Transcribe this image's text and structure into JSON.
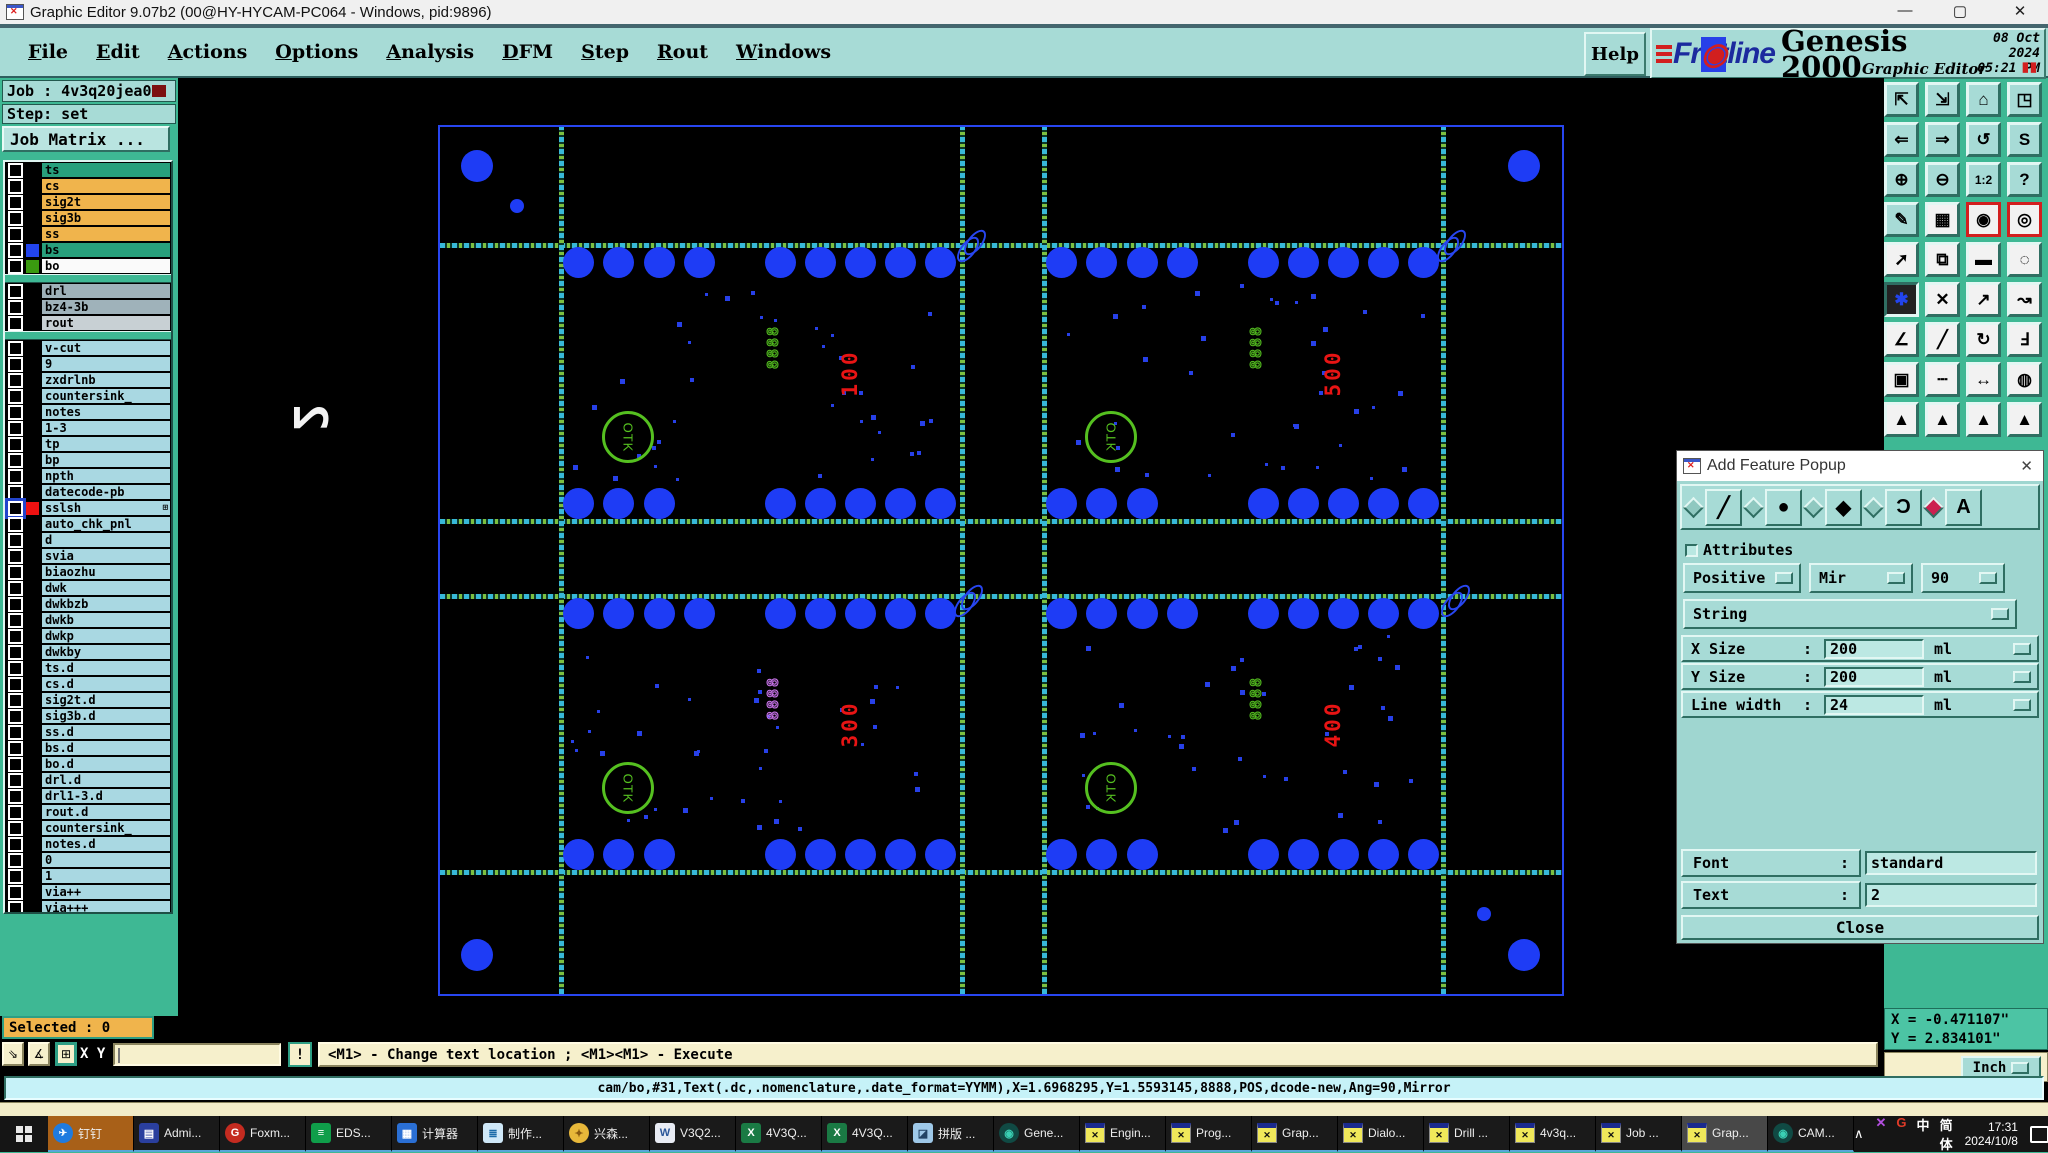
{
  "title_bar": {
    "title": "Graphic Editor 9.07b2 (00@HY-HYCAM-PC064 - Windows, pid:9896)",
    "minimize": "—",
    "maximize": "▢",
    "close": "✕"
  },
  "menu_bar": {
    "items": [
      "File",
      "Edit",
      "Actions",
      "Options",
      "Analysis",
      "DFM",
      "Step",
      "Rout",
      "Windows"
    ],
    "help": "Help"
  },
  "brand": {
    "logo_text": "Frontline",
    "product": "Genesis 2000",
    "date": "08 Oct 2024",
    "time": "05:21 PM",
    "subtitle": "Graphic Editor",
    "pause_icon": "▮▮"
  },
  "sidebar": {
    "job_label": "Job : 4v3q20jea0",
    "step_label": "Step: set",
    "job_matrix_label": "Job Matrix ...",
    "layers": [
      {
        "name": "ts",
        "bg": "teal"
      },
      {
        "name": "cs",
        "bg": "orange"
      },
      {
        "name": "sig2t",
        "bg": "orange"
      },
      {
        "name": "sig3b",
        "bg": "orange"
      },
      {
        "name": "ss",
        "bg": "orange"
      },
      {
        "name": "bs",
        "bg": "teal",
        "chip": "#2244ee"
      },
      {
        "name": "bo",
        "bg": "white",
        "chip": "#3a9a10"
      },
      {
        "gap": true
      },
      {
        "name": "drl",
        "bg": "gray"
      },
      {
        "name": "bz4-3b",
        "bg": "gray"
      },
      {
        "name": "rout",
        "bg": "lgray"
      },
      {
        "gap": true
      },
      {
        "name": "v-cut",
        "bg": "pale"
      },
      {
        "name": "9",
        "bg": "pale"
      },
      {
        "name": "zxdrlnb",
        "bg": "pale"
      },
      {
        "name": "countersink_",
        "bg": "pale"
      },
      {
        "name": "notes",
        "bg": "pale"
      },
      {
        "name": "1-3",
        "bg": "pale"
      },
      {
        "name": "tp",
        "bg": "pale"
      },
      {
        "name": "bp",
        "bg": "pale"
      },
      {
        "name": "npth",
        "bg": "pale"
      },
      {
        "name": "datecode-pb",
        "bg": "pale"
      },
      {
        "name": "sslsh",
        "bg": "pale",
        "chip": "#ee1111",
        "selected": true,
        "suffix": "⊞"
      },
      {
        "name": "auto_chk_pnl",
        "bg": "pale"
      },
      {
        "name": "d",
        "bg": "pale"
      },
      {
        "name": "svia",
        "bg": "pale"
      },
      {
        "name": "biaozhu",
        "bg": "pale"
      },
      {
        "name": "dwk",
        "bg": "pale"
      },
      {
        "name": "dwkbzb",
        "bg": "pale"
      },
      {
        "name": "dwkb",
        "bg": "pale"
      },
      {
        "name": "dwkp",
        "bg": "pale"
      },
      {
        "name": "dwkby",
        "bg": "pale"
      },
      {
        "name": "ts.d",
        "bg": "pale"
      },
      {
        "name": "cs.d",
        "bg": "pale"
      },
      {
        "name": "sig2t.d",
        "bg": "pale"
      },
      {
        "name": "sig3b.d",
        "bg": "pale"
      },
      {
        "name": "ss.d",
        "bg": "pale"
      },
      {
        "name": "bs.d",
        "bg": "pale"
      },
      {
        "name": "bo.d",
        "bg": "pale"
      },
      {
        "name": "drl.d",
        "bg": "pale"
      },
      {
        "name": "drl1-3.d",
        "bg": "pale"
      },
      {
        "name": "rout.d",
        "bg": "pale"
      },
      {
        "name": "countersink_",
        "bg": "pale"
      },
      {
        "name": "notes.d",
        "bg": "pale"
      },
      {
        "name": "0",
        "bg": "pale"
      },
      {
        "name": "1",
        "bg": "pale"
      },
      {
        "name": "via++",
        "bg": "pale"
      },
      {
        "name": "via+++",
        "bg": "pale"
      }
    ]
  },
  "right_toolbar": {
    "rows": [
      [
        {
          "n": "zoom-in-window-icon",
          "g": "⇱"
        },
        {
          "n": "zoom-out-window-icon",
          "g": "⇲"
        },
        {
          "n": "home-view-icon",
          "g": "⌂"
        },
        {
          "n": "window-xy-icon",
          "g": "◳"
        }
      ],
      [
        {
          "n": "pan-left-icon",
          "g": "⇐"
        },
        {
          "n": "pan-right-icon",
          "g": "⇒"
        },
        {
          "n": "previous-view-icon",
          "g": "↺"
        },
        {
          "n": "profile-path-icon",
          "g": "S"
        }
      ],
      [
        {
          "n": "expand-view-icon",
          "g": "⊕"
        },
        {
          "n": "shrink-view-icon",
          "g": "⊖"
        },
        {
          "n": "scale-1-2-icon",
          "g": "1:2"
        },
        {
          "n": "help-question-icon",
          "g": "?"
        }
      ],
      [
        {
          "n": "editor-tools-icon",
          "g": "✎"
        },
        {
          "n": "grid-icon",
          "g": "▦",
          "c": "white"
        },
        {
          "n": "net-highlight-a-icon",
          "g": "◉",
          "c": "redbox"
        },
        {
          "n": "net-highlight-b-icon",
          "g": "◎",
          "c": "redbox"
        }
      ],
      [
        {
          "n": "move-feature-icon",
          "g": "➚",
          "c": "white"
        },
        {
          "n": "copy-feature-icon",
          "g": "⧉",
          "c": "white"
        },
        {
          "n": "measure-icon",
          "g": "▬",
          "c": "white"
        },
        {
          "n": "select-pad-icon",
          "g": "◌",
          "c": "white"
        }
      ],
      [
        {
          "n": "cluster-icon",
          "g": "✱",
          "c": "pressed"
        },
        {
          "n": "delete-feature-icon",
          "g": "✕",
          "c": "white"
        },
        {
          "n": "resize-up-icon",
          "g": "↗",
          "c": "white"
        },
        {
          "n": "resize-down-icon",
          "g": "↝",
          "c": "white"
        }
      ],
      [
        {
          "n": "angle-measure-icon",
          "g": "∠",
          "c": "white"
        },
        {
          "n": "slope-line-icon",
          "g": "╱",
          "c": "white"
        },
        {
          "n": "rotate-feature-icon",
          "g": "↻",
          "c": "white"
        },
        {
          "n": "mirror-feature-icon",
          "g": "Ⅎ",
          "c": "white"
        }
      ],
      [
        {
          "n": "pad-swap-icon",
          "g": "▣",
          "c": "white"
        },
        {
          "n": "dash-line-icon",
          "g": "┄",
          "c": "white"
        },
        {
          "n": "width-measure-icon",
          "g": "↔",
          "c": "white"
        },
        {
          "n": "overlap-circles-icon",
          "g": "◍",
          "c": "white"
        }
      ],
      [
        {
          "n": "apex-a-icon",
          "g": "▲",
          "c": "white"
        },
        {
          "n": "apex-b-icon",
          "g": "▲",
          "c": "white"
        },
        {
          "n": "apex-c-icon",
          "g": "▲",
          "c": "white"
        },
        {
          "n": "apex-d-icon",
          "g": "▲",
          "c": "white"
        }
      ]
    ]
  },
  "canvas": {
    "boards": [
      {
        "id": "top-left",
        "number": "100",
        "otk": "OTK",
        "datecode": "8888",
        "mirrored": false,
        "datecode_selected": false
      },
      {
        "id": "top-right",
        "number": "500",
        "otk": "OTK",
        "datecode": "8888",
        "mirrored": true,
        "datecode_selected": false
      },
      {
        "id": "bottom-left",
        "number": "300",
        "otk": "OTK",
        "datecode": "8888",
        "mirrored": false,
        "datecode_selected": true
      },
      {
        "id": "bottom-right",
        "number": "400",
        "otk": "OTK",
        "datecode": "8888",
        "mirrored": true,
        "datecode_selected": false
      }
    ],
    "ghost_text": "2",
    "colors": {
      "pad_blue": "#1e3cf5",
      "outline_blue": "#2846f0",
      "silk_green": "#55c020",
      "text_red": "#e81414"
    }
  },
  "popup": {
    "title": "Add Feature Popup",
    "close_icon": "✕",
    "tools": [
      {
        "name": "line-tool",
        "glyph": "╱",
        "selected": false
      },
      {
        "name": "pad-tool",
        "glyph": "●",
        "selected": false
      },
      {
        "name": "surface-tool",
        "glyph": "◆",
        "selected": false
      },
      {
        "name": "arc-tool",
        "glyph": "Ɔ",
        "selected": false
      },
      {
        "name": "text-tool",
        "glyph": "A",
        "selected": true
      }
    ],
    "attributes_label": "Attributes",
    "polarity": "Positive",
    "mirror": "Mir",
    "angle": "90",
    "shape": "String",
    "x_size_label": "X Size",
    "x_size_value": "200",
    "x_size_unit": "ml",
    "y_size_label": "Y Size",
    "y_size_value": "200",
    "y_size_unit": "ml",
    "line_width_label": "Line width",
    "line_width_value": "24",
    "line_width_unit": "ml",
    "font_label": "Font",
    "font_value": "standard",
    "text_label": "Text",
    "text_value": "2",
    "colon": ":",
    "close_label": "Close"
  },
  "status": {
    "selected_label": "Selected : 0",
    "xy_label": "X Y :",
    "xy_value": "",
    "excl_label": "!",
    "message": "<M1> - Change text location ; <M1><M1> - Execute",
    "command": "cam/bo,#31,Text(.dc,.nomenclature,.date_format=YYMM),X=1.6968295,Y=1.5593145,8888,POS,dcode-new,Ang=90,Mirror",
    "coord_x": "X = -0.471107\"",
    "coord_y": "Y = 2.834101\"",
    "unit": "Inch"
  },
  "taskbar": {
    "items": [
      {
        "label": "钉钉",
        "icon": "ding",
        "state": "orange"
      },
      {
        "label": "Admi...",
        "icon": "floppy"
      },
      {
        "label": "Foxm...",
        "icon": "fox"
      },
      {
        "label": "EDS...",
        "icon": "eds"
      },
      {
        "label": "计算器",
        "icon": "calc"
      },
      {
        "label": "制作...",
        "icon": "doc"
      },
      {
        "label": "兴森...",
        "icon": "shell"
      },
      {
        "label": "V3Q2...",
        "icon": "word"
      },
      {
        "label": "4V3Q...",
        "icon": "xls"
      },
      {
        "label": "4V3Q...",
        "icon": "xls"
      },
      {
        "label": "拼版 ...",
        "icon": "img"
      },
      {
        "label": "Gene...",
        "icon": "gen"
      },
      {
        "label": "Engin...",
        "icon": "xwin"
      },
      {
        "label": "Prog...",
        "icon": "xwin"
      },
      {
        "label": "Grap...",
        "icon": "xwin"
      },
      {
        "label": "Dialo...",
        "icon": "xwin"
      },
      {
        "label": "Drill ...",
        "icon": "xwin"
      },
      {
        "label": "4v3q...",
        "icon": "xwin"
      },
      {
        "label": "Job ...",
        "icon": "xwin"
      },
      {
        "label": "Grap...",
        "icon": "xwin",
        "state": "current"
      },
      {
        "label": "CAM...",
        "icon": "gen"
      }
    ],
    "tray": {
      "chevron": "∧",
      "icons": [
        {
          "label": "✕",
          "color": "#b44fe0",
          "name": "tray-x-icon"
        },
        {
          "label": "G",
          "color": "#e03b28",
          "name": "tray-g-icon"
        },
        {
          "label": "中",
          "color": "#ffffff",
          "name": "ime-lang-icon"
        },
        {
          "label": "简体",
          "color": "#ffffff",
          "name": "ime-variant-label"
        }
      ],
      "time": "17:31",
      "date": "2024/10/8",
      "badge": "1"
    }
  }
}
